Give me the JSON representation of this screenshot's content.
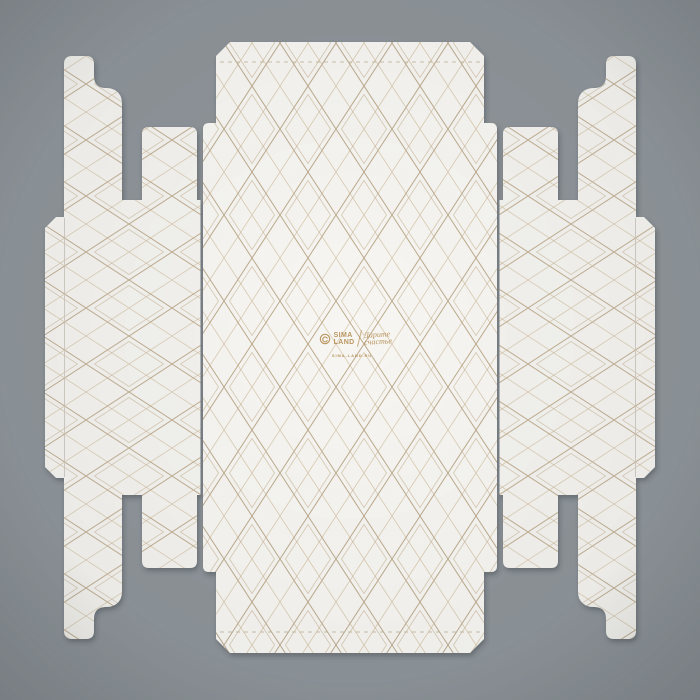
{
  "colors": {
    "background": "#8e9499",
    "panel_center": "#f7f6f2",
    "panel_side": "#f4f3ef",
    "pattern_gold_main": "#a8906a",
    "pattern_gold_inner": "#b79d76",
    "pattern_gold_cross": "#c2a97e",
    "perforation": "#b9aa8d",
    "crease": "#ddd8cf",
    "logo_gold": "#b08648"
  },
  "logo": {
    "brand_line1": "SIMA",
    "brand_line2": "LAND",
    "tagline_line1": "Дарите",
    "tagline_line2": "счастье",
    "website": "SIMA-LAND.RU"
  }
}
